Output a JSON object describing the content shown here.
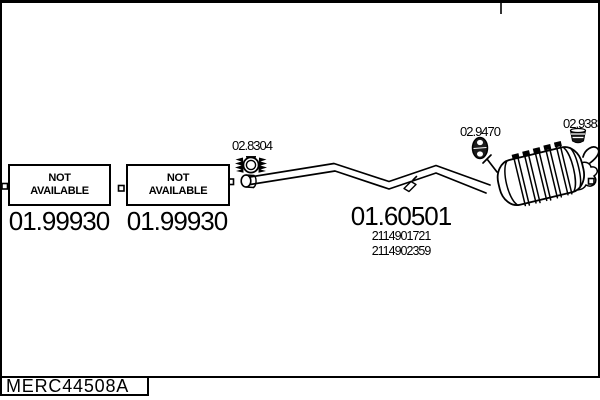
{
  "colors": {
    "ink": "#000000",
    "paper": "#ffffff"
  },
  "availability_boxes": [
    {
      "line1": "NOT",
      "line2": "AVAILABLE",
      "part_number": "01.99930"
    },
    {
      "line1": "NOT",
      "line2": "AVAILABLE",
      "part_number": "01.99930"
    }
  ],
  "part_labels": {
    "clamp": "02.8304",
    "rubber_hanger": "02.9470",
    "bracket_hanger": "02.9383"
  },
  "main_part": {
    "number": "01.60501",
    "oem_ref1": "2114901721",
    "oem_ref2": "2114902359"
  },
  "footer": {
    "drawing_code": "MERC44508A"
  }
}
